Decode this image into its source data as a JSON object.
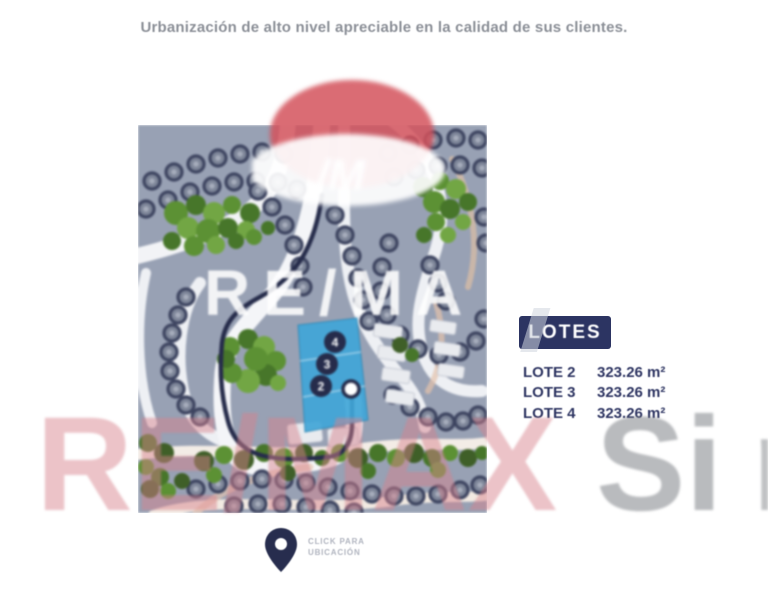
{
  "page": {
    "caption": "Urbanización de alto nivel apreciable en la calidad de sus clientes."
  },
  "lotes_panel": {
    "title": "LOTES",
    "items": [
      {
        "label": "LOTE 2",
        "area": "323.26 m²"
      },
      {
        "label": "LOTE 3",
        "area": "323.26 m²"
      },
      {
        "label": "LOTE 4",
        "area": "323.26 m²"
      }
    ]
  },
  "map": {
    "lot_markers": [
      "4",
      "3",
      "2"
    ],
    "watermark": "RE/MA",
    "balloon_label": "/M",
    "highlight_color": "#41a6d8"
  },
  "location_cta": {
    "line1": "CLICK PARA",
    "line2": "UBICACIÓN"
  },
  "watermark": {
    "brand": "RE/MAX",
    "suffix": "Si",
    "clipped": "n",
    "pink": "#d8828d",
    "gray": "#74777d"
  },
  "colors": {
    "navy": "#2c3462",
    "route": "#262c4b",
    "parcel_base": "#98a1b4"
  }
}
